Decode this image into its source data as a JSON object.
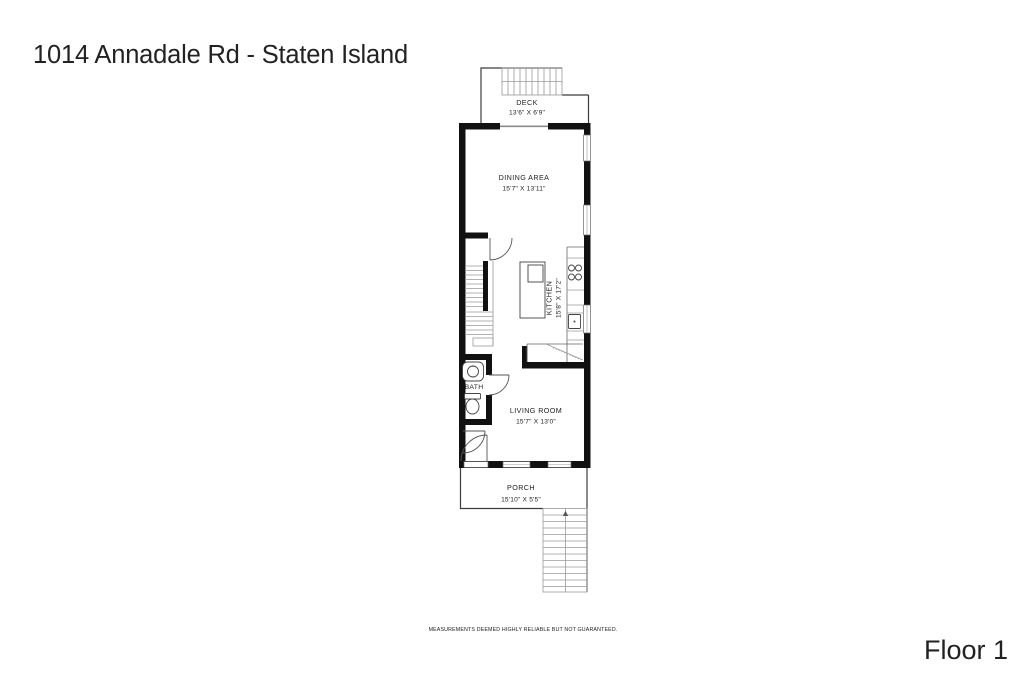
{
  "page": {
    "title": "1014 Annadale Rd - Staten Island",
    "floor_label": "Floor 1",
    "disclaimer": "MEASUREMENTS DEEMED HIGHLY RELIABLE BUT NOT GUARANTEED."
  },
  "rooms": {
    "deck": {
      "name": "DECK",
      "dims": "13'6\" X 6'9\""
    },
    "dining": {
      "name": "DINING AREA",
      "dims": "15'7\" X 13'11\""
    },
    "kitchen": {
      "name": "KITCHEN",
      "dims": "15'8\" X 17'2\""
    },
    "bath": {
      "name": "BATH"
    },
    "living": {
      "name": "LIVING ROOM",
      "dims": "15'7\" X 13'0\""
    },
    "porch": {
      "name": "PORCH",
      "dims": "15'10\" X 5'5\""
    }
  },
  "colors": {
    "wall": "#111111",
    "thin_line": "#3c3c3c",
    "tread_line": "#9a9a9a",
    "text": "#222222"
  }
}
